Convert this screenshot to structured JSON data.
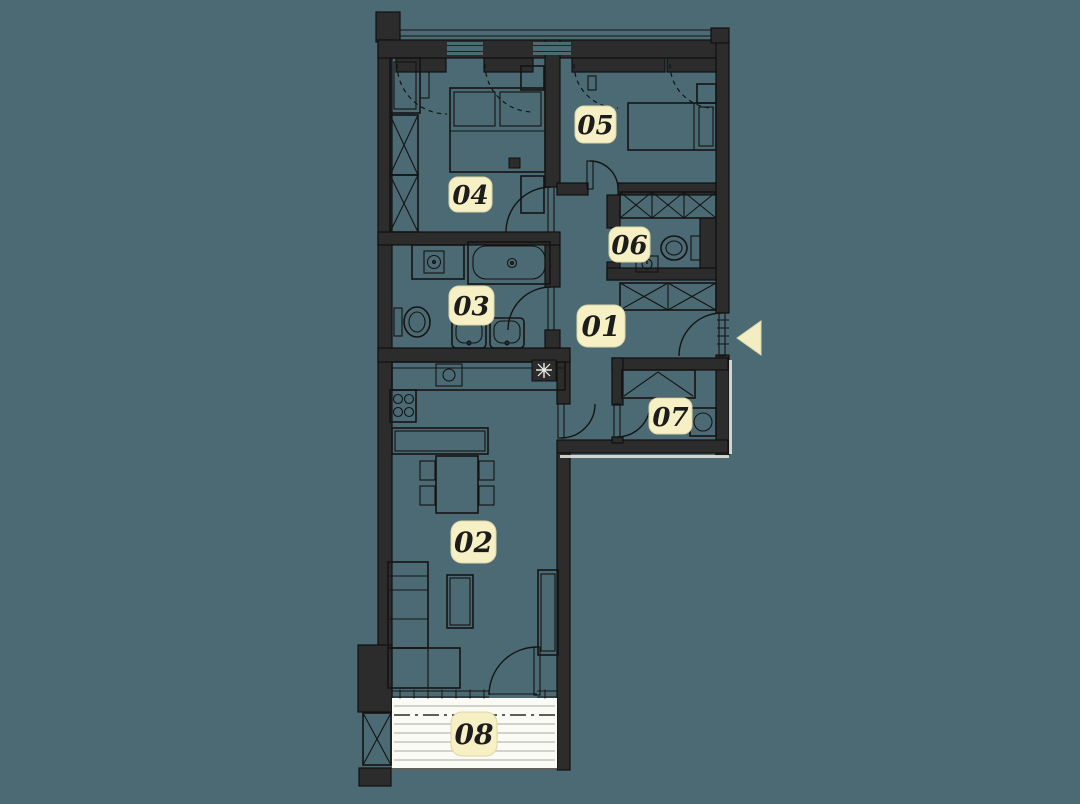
{
  "plan": {
    "rooms": [
      {
        "label": "01"
      },
      {
        "label": "02"
      },
      {
        "label": "03"
      },
      {
        "label": "04"
      },
      {
        "label": "05"
      },
      {
        "label": "06"
      },
      {
        "label": "07"
      },
      {
        "label": "08"
      }
    ],
    "entrance": {
      "icon": "entrance-arrow-icon",
      "direction": "left"
    }
  },
  "colors": {
    "background": "#4b6a73",
    "wall_fill": "#2c2c2c",
    "wall_stroke": "#101010",
    "furniture_line": "#141414",
    "label_background": "#f6f0c4",
    "label_border": "#ddd6a8",
    "label_text": "#1c1c1c",
    "balcony_background": "#fbfbf5",
    "balcony_stripe": "#b9b9b2",
    "entrance_arrow": "#f3edc4",
    "keyline": "#e9e9e3"
  }
}
